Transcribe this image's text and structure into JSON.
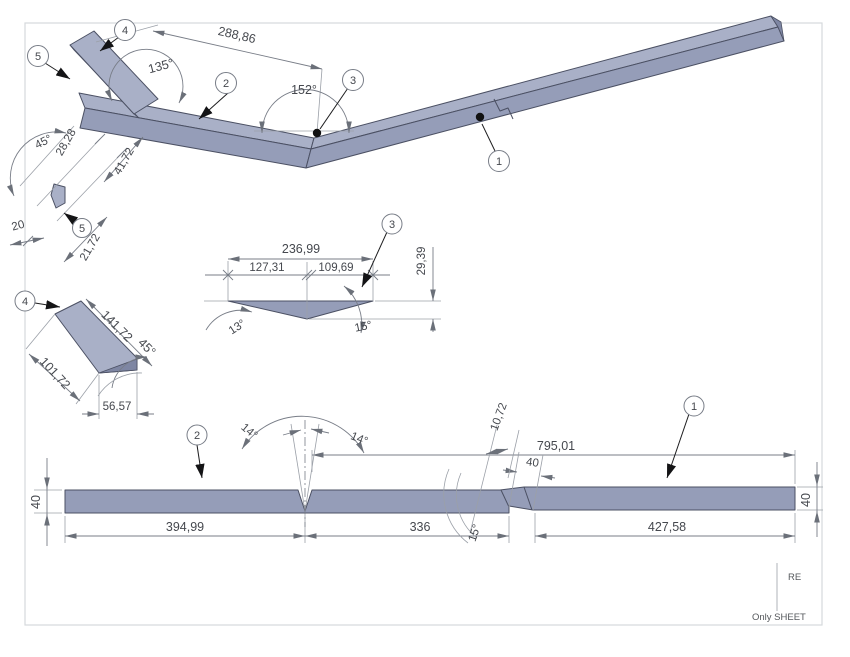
{
  "colors": {
    "face_top": "#a9b0c7",
    "face_front": "#959db8",
    "face_dark": "#7e86a3",
    "edge": "#4b5063",
    "dim": "#787d87",
    "dim_light": "#9ba0a8",
    "ink": "#45484e",
    "frame": "#d6d9dc"
  },
  "iso_view": {
    "dim_288": "288,86",
    "angle_135": "135°",
    "angle_152": "152°",
    "balloon_1": "1",
    "balloon_2": "2",
    "balloon_3": "3",
    "balloon_4": "4",
    "balloon_5": "5"
  },
  "corner_detail": {
    "angle_45": "45°",
    "dim_28_28": "28,28",
    "dim_41_72": "41,72",
    "dim_20": "20",
    "dim_21_72": "21,72",
    "balloon": "5"
  },
  "vee_detail": {
    "dim_236_99": "236,99",
    "dim_127_31": "127,31",
    "dim_109_69": "109,69",
    "dim_29_39": "29,39",
    "angle_13": "13°",
    "angle_15": "15°",
    "balloon": "3"
  },
  "tab_detail": {
    "dim_141_72": "141,72",
    "angle_45": "45°",
    "dim_101_72": "101,72",
    "dim_56_57": "56,57",
    "balloon": "4"
  },
  "flat_view": {
    "dim_40_left": "40",
    "dim_394_99": "394,99",
    "dim_336": "336",
    "dim_427_58": "427,58",
    "dim_795_01": "795,01",
    "dim_40_seg": "40",
    "dim_10_72": "10,72",
    "angle_14_left": "14°",
    "angle_14_right": "14°",
    "angle_15": "15°",
    "dim_40_right": "40",
    "balloon_1": "1",
    "balloon_2": "2"
  },
  "title_block": {
    "re": "RE",
    "only_sheet": "Only SHEET"
  }
}
